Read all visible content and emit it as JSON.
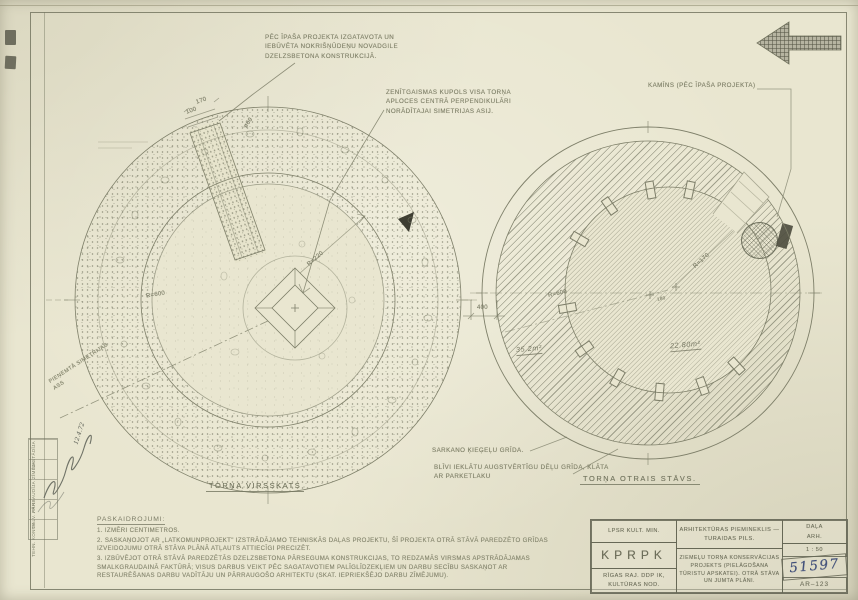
{
  "colors": {
    "paper": "#e9e6d0",
    "pencil_line": "#80816b",
    "pencil_text": "#81826a",
    "hand_ink": "#41507a",
    "dark_fill": "#3e3e33"
  },
  "icons": {
    "north_arrow": "left-arrow-icon"
  },
  "callouts": {
    "gutter": "PĒC ĪPAŠA PROJEKTA IZGATAVOTA UN IEBŪVĒTA NOKRIŠŅŪDEŅU NOVADGILE DZELZSBETONA KONSTRUKCIJĀ.",
    "dome": "ZENĪTGAISMAS KUPOLS VISA TORŅA APLOCES CENTRĀ PERPENDIKULĀRI NORĀDĪTAJAI SIMETRIJAS ASIJ.",
    "chimney": "KAMĪNS (PĒC ĪPAŠA PROJEKTA)",
    "brick_floor": "SARKANO ĶIEĢEĻU GRĪDA.",
    "plank_floor": "BLĪVI IEKLĀTU AUGSTVĒRTĪGU DĒĻU GRĪDA, KLĀTA AR PARKETLAKU",
    "symmetry_axis": "PIEŅEMTĀ SIMETRIJAS ASS"
  },
  "left_plan": {
    "caption": "TORŅA VIRSSKATS",
    "r_outer": "R=600",
    "r_inner": "R=220",
    "dim_a": "170",
    "dim_b": "100",
    "dim_c": "ø60"
  },
  "right_plan": {
    "caption": "TORŅA OTRAIS STĀVS.",
    "r_outer": "R=600",
    "r_inner": "R=170",
    "dim_wall": "400",
    "dim_center": "180",
    "area_ring": "35.2m²",
    "area_core": "22.80m²"
  },
  "notes": {
    "heading": "PASKAIDROJUMI:",
    "items": [
      "1. IZMĒRI CENTIMETROS.",
      "2. SASKAŅOJOT AR „LATKOMUNPROJEKT\" IZSTRĀDĀJAMO TEHNISKĀS DAĻAS PROJEKTU, ŠĪ PROJEKTA OTRĀ STĀVĀ PAREDZĒTO GRĪDAS IZVEIDOJUMU OTRĀ STĀVA PLĀNĀ ATĻAUTS ATTIECĪGI PRECIZĒT.",
      "3. IZBŪVĒJOT OTRĀ STĀVĀ PAREDZĒTĀS DZELZSBETONA PĀRSEGUMA KONSTRUKCIJAS, TO REDZAMĀS VIRSMAS APSTRĀDĀJAMAS SMALKGRAUDAINĀ FAKTŪRĀ; VISUS DARBUS VEIKT PĒC SAGATAVOTIEM PALĪGLĪDZEKĻIEM UN DARBU SECĪBU SASKAŅOT AR RESTAURĒŠANAS DARBU VADĪTĀJU UN PĀRRAUGOŠO ARHITEKTU (SKAT. IEPRIEKŠĒJO DARBU ZĪMĒJUMU)."
    ]
  },
  "title_block": {
    "org_ministry": "LPSR KULT. MIN.",
    "org_office": "KPRPK",
    "org_dept": "RĪGAS RAJ. DDP IK, KULTŪRAS NOD.",
    "monument": "ARHITEKTŪRAS PIEMINEKLIS — TURAIDAS PILS.",
    "project": "ZIEMEĻU TORŅA KONSERVĀCIJAS PROJEKTS (PIELĀGOŠANA TŪRISTU APSKATEI). OTRĀ STĀVA UN JUMTA PLĀNI.",
    "section_label": "DAĻA",
    "section_value": "ARH.",
    "scale": "1 : 50",
    "inventory_number": "51597",
    "sheet_number": "AR–123"
  },
  "stamp": {
    "rows": [
      "SASTĀDĪJA",
      "ZĪMĒJA",
      "PĀRBAUDĪJA",
      "GALV. ARH.",
      "TEHN. KONTR."
    ],
    "date": "12.4.72"
  }
}
